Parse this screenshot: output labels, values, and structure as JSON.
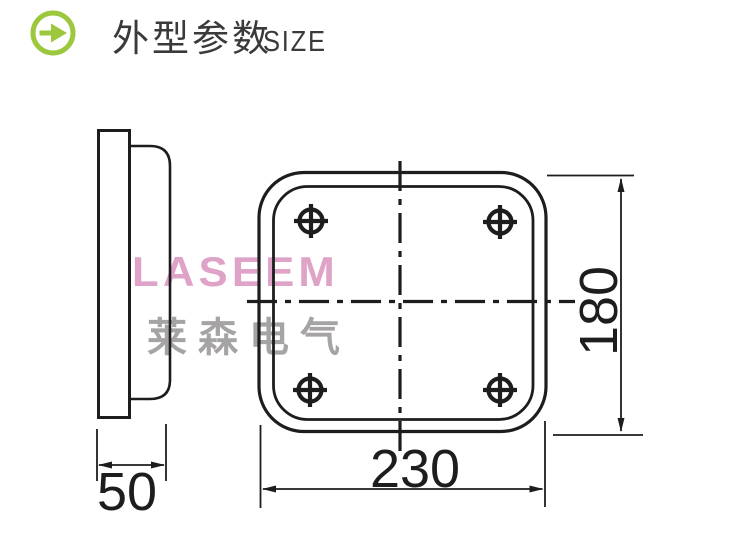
{
  "header": {
    "icon": "arrow-right-circle-icon",
    "title_zh": "外型参数",
    "title_en": "SIZE",
    "accent_color": "#9cc83e",
    "text_color": "#3a3a3a"
  },
  "watermark": {
    "brand": "LASEEM",
    "brand_color": "#dfa3c8",
    "brand_zh": "莱森电气",
    "brand_zh_color": "#a5a3a4"
  },
  "drawing": {
    "type": "technical-dimension-drawing",
    "line_color": "#1d1d1d",
    "views": [
      {
        "id": "side-view"
      },
      {
        "id": "front-view"
      }
    ],
    "mounting_holes": 4,
    "dimensions": {
      "depth": {
        "value": "50",
        "view": "side-view"
      },
      "width": {
        "value": "230",
        "view": "front-view"
      },
      "height": {
        "value": "180",
        "view": "front-view"
      }
    }
  }
}
